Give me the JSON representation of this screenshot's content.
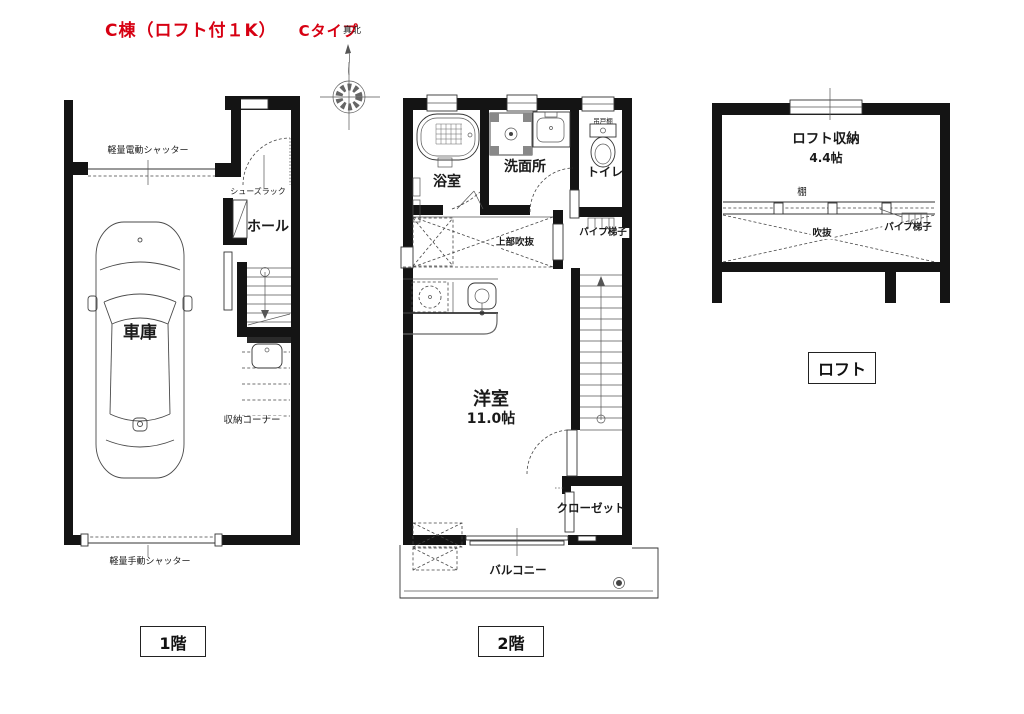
{
  "title": {
    "building": "C棟（ロフト付１K）",
    "type": "Cタイプ"
  },
  "compass": {
    "north_label": "真北"
  },
  "floor1": {
    "tag": "1階",
    "garage": "車庫",
    "hall": "ホール",
    "shoe_rack": "シューズラック",
    "storage_corner": "収納コーナー",
    "electric_shutter": "軽量電動シャッター",
    "manual_shutter": "軽量手動シャッター"
  },
  "floor2": {
    "tag": "2階",
    "bathroom": "浴室",
    "washroom": "洗面所",
    "hanging_cupboard": "吊戸棚",
    "toilet": "トイレ",
    "void_above": "上部吹抜",
    "pipe_ladder": "パイプ梯子",
    "western_room": "洋室",
    "western_room_size": "11.0帖",
    "closet": "クローゼット",
    "balcony": "バルコニー"
  },
  "loft": {
    "tag": "ロフト",
    "storage": "ロフト収納",
    "storage_size": "4.4帖",
    "shelf": "棚",
    "void": "吹抜",
    "pipe_ladder": "パイプ梯子"
  },
  "colors": {
    "title_red": "#d70012",
    "wall": "#141414"
  }
}
